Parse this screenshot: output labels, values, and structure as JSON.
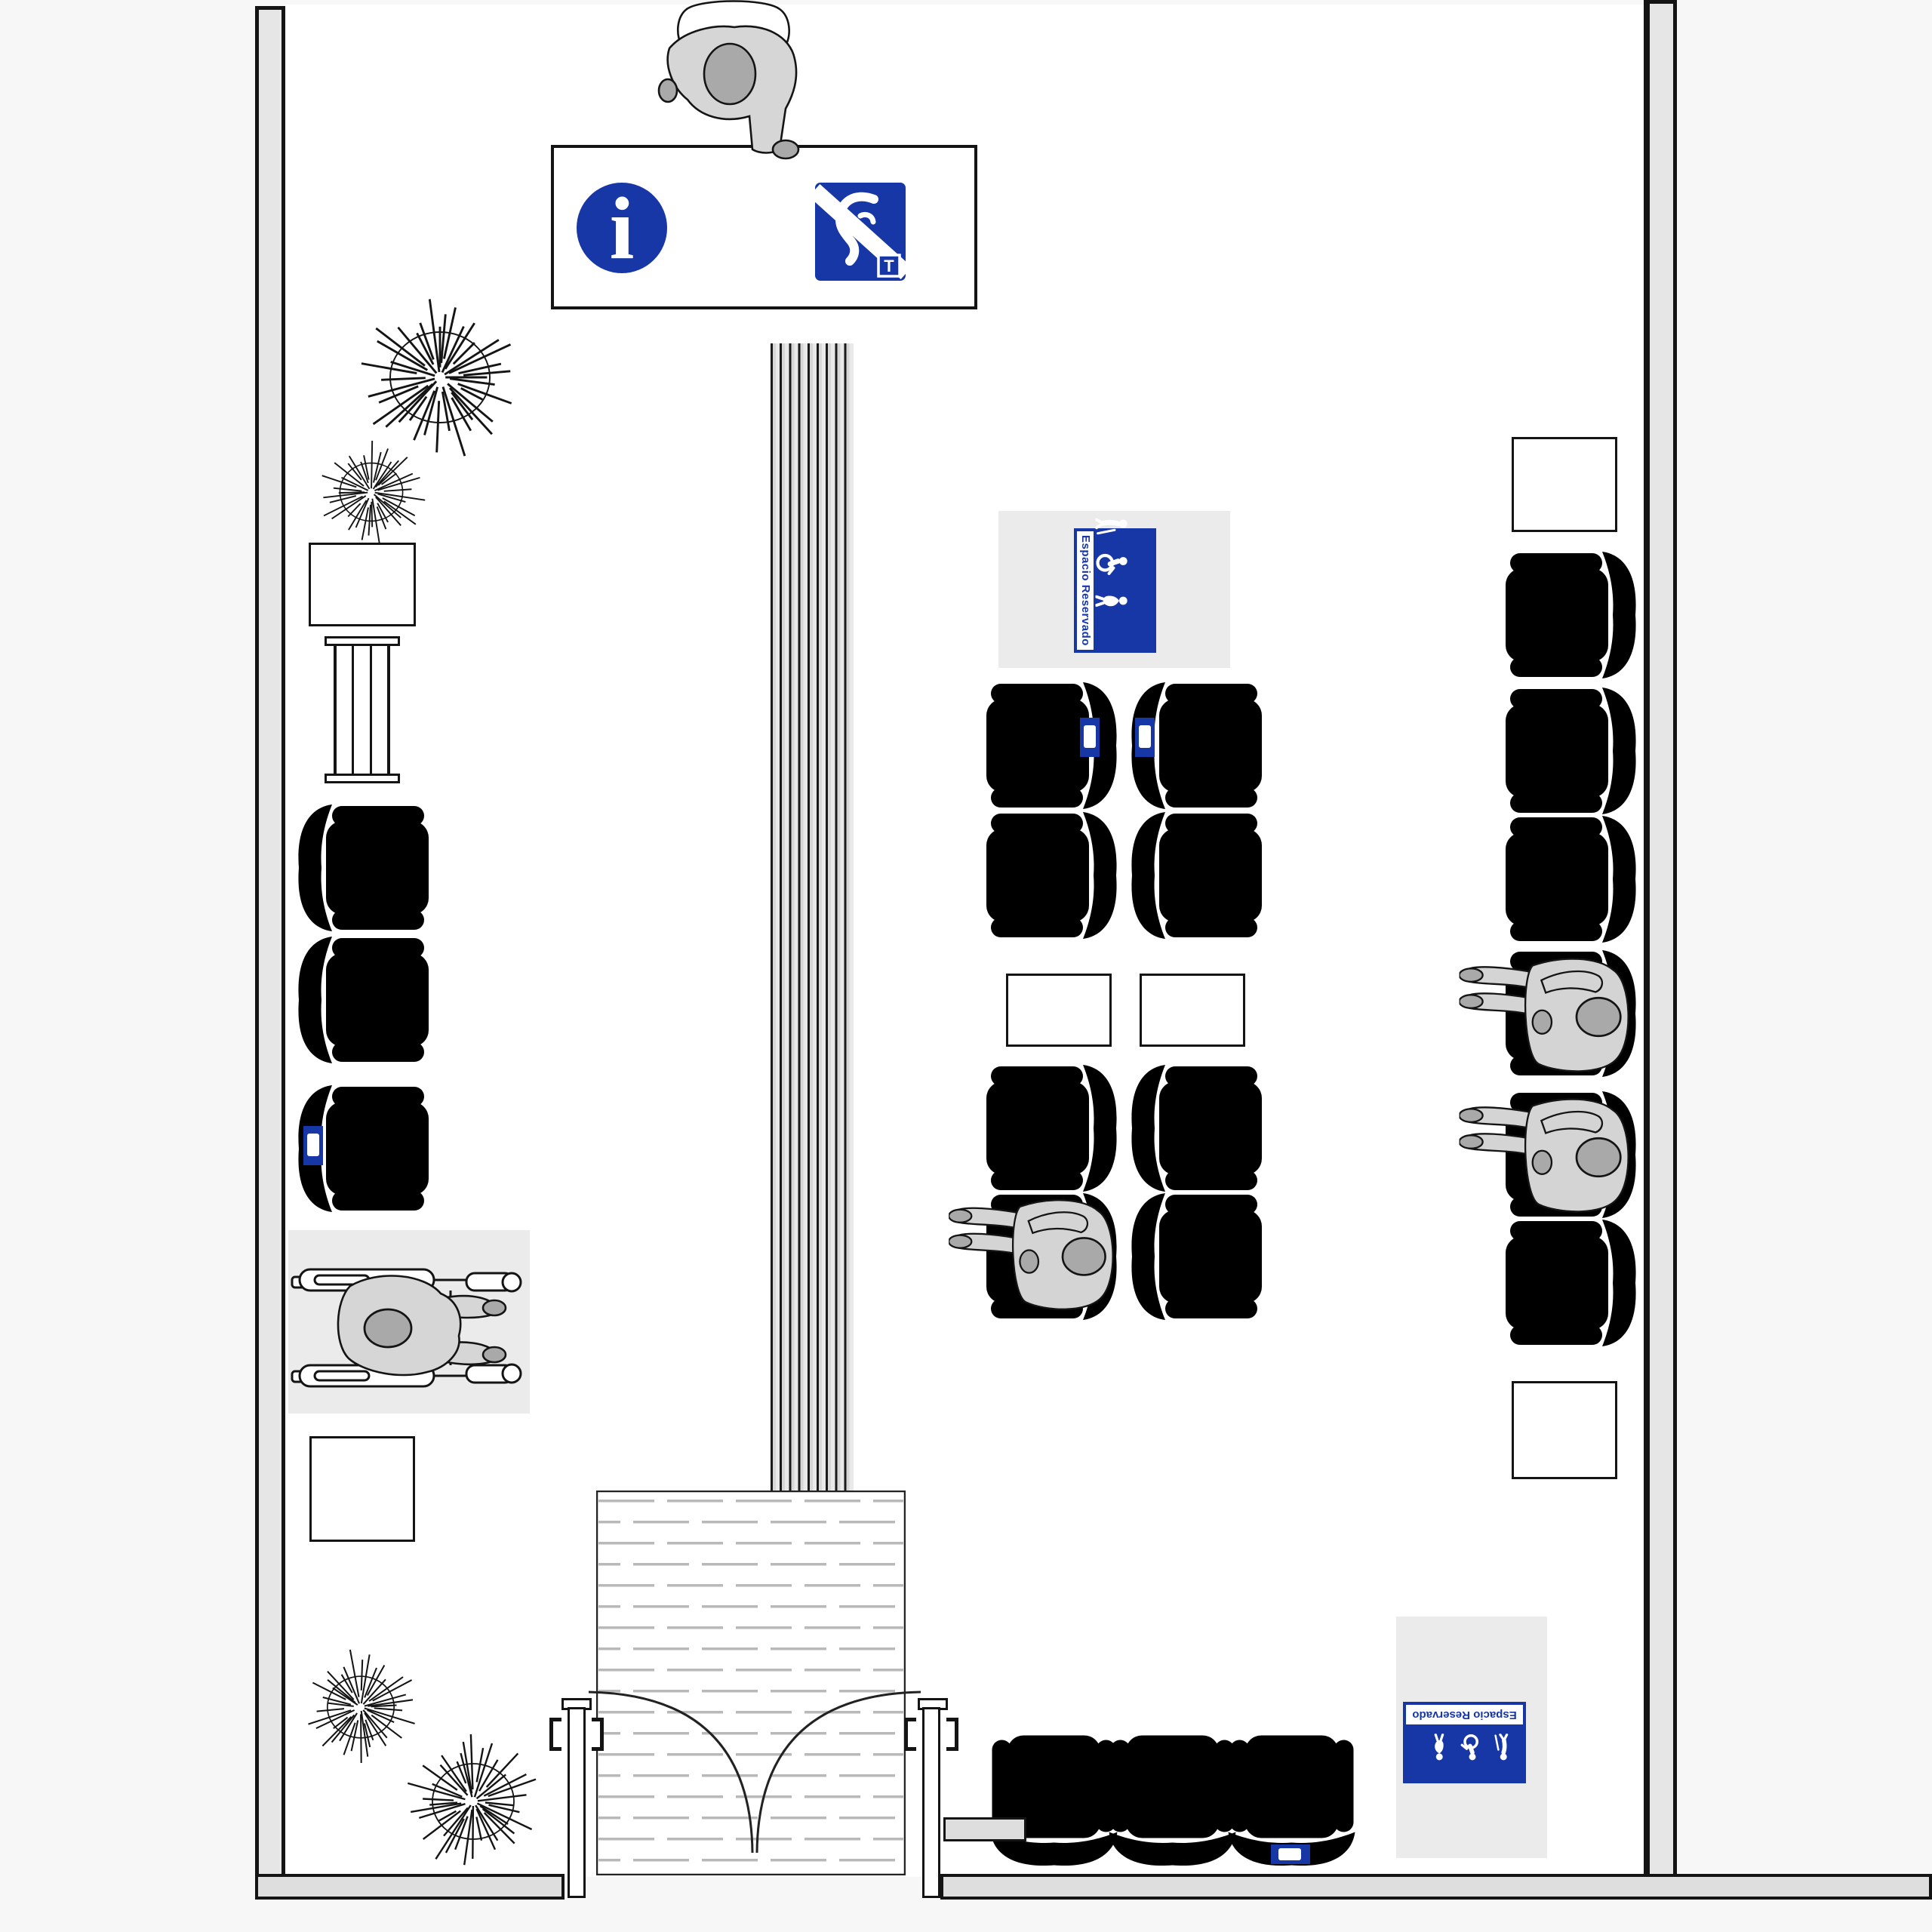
{
  "scene": {
    "kind": "floor-plan",
    "setting": "accessible waiting room, top view",
    "entrance": "double inward-swinging door with textured mat",
    "tactile_guide_path": "striped strip from information counter to entrance"
  },
  "colors": {
    "accent_blue": "#1737A6",
    "reserved_seat_fill": "#CCD2E4",
    "reserved_seat_stroke": "#2239B5",
    "wall_fill": "#E6E6E6",
    "exterior_bg": "#F7F7F7",
    "zone_bg": "#EBEBEB",
    "figure_fill": "#D6D6D6",
    "figure_dark": "#A9A9A9",
    "outline": "#141414"
  },
  "signs": {
    "info_counter": {
      "icons": [
        {
          "name": "information-icon",
          "glyph": "i"
        },
        {
          "name": "hearing-loop-icon",
          "letter": "T"
        }
      ]
    },
    "reserved_top": {
      "label": "Espacio Reservado",
      "icons": [
        "person-with-cane-icon",
        "wheelchair-icon",
        "pregnant-woman-icon"
      ]
    },
    "reserved_bottom": {
      "label": "Espacio Reservado",
      "icons": [
        "person-with-cane-icon",
        "wheelchair-icon",
        "pregnant-woman-icon"
      ]
    }
  },
  "inventory": {
    "seats_white": 16,
    "seats_reserved_blue": 4,
    "tables": 6,
    "plants": 4,
    "magazine_racks": 1,
    "people_standing": 1,
    "people_seated": 3,
    "wheelchair_users": 1
  }
}
